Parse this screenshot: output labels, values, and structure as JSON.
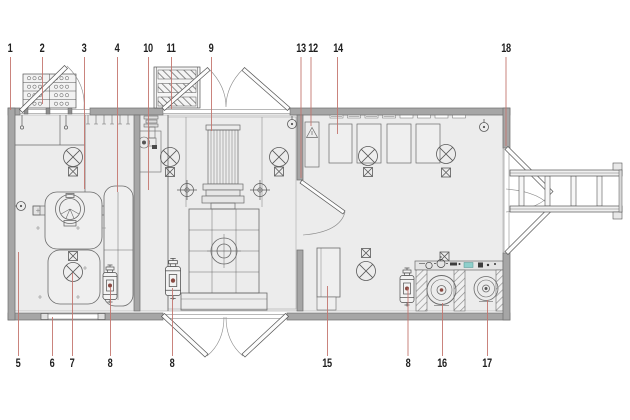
{
  "figure": {
    "kind": "floor-plan",
    "units": "none-visible"
  },
  "callouts": {
    "top": [
      {
        "label": "1"
      },
      {
        "label": "2"
      },
      {
        "label": "3"
      },
      {
        "label": "4"
      },
      {
        "label": "10"
      },
      {
        "label": "11"
      },
      {
        "label": "9"
      },
      {
        "label": "13"
      },
      {
        "label": "12"
      },
      {
        "label": "14"
      },
      {
        "label": "18"
      }
    ],
    "bottom": [
      {
        "label": "5"
      },
      {
        "label": "6"
      },
      {
        "label": "7"
      },
      {
        "label": "8"
      },
      {
        "label": "8"
      },
      {
        "label": "15"
      },
      {
        "label": "8"
      },
      {
        "label": "16"
      },
      {
        "label": "17"
      }
    ]
  },
  "colors": {
    "background": "#ffffff",
    "floor_fill": "#ececec",
    "wall_fill": "#a6a6a6",
    "linework": "#565656",
    "leader_line": "#c4766f",
    "accent_teal": "#8ecfcb",
    "extinguisher_dot": "#8a4a42"
  }
}
